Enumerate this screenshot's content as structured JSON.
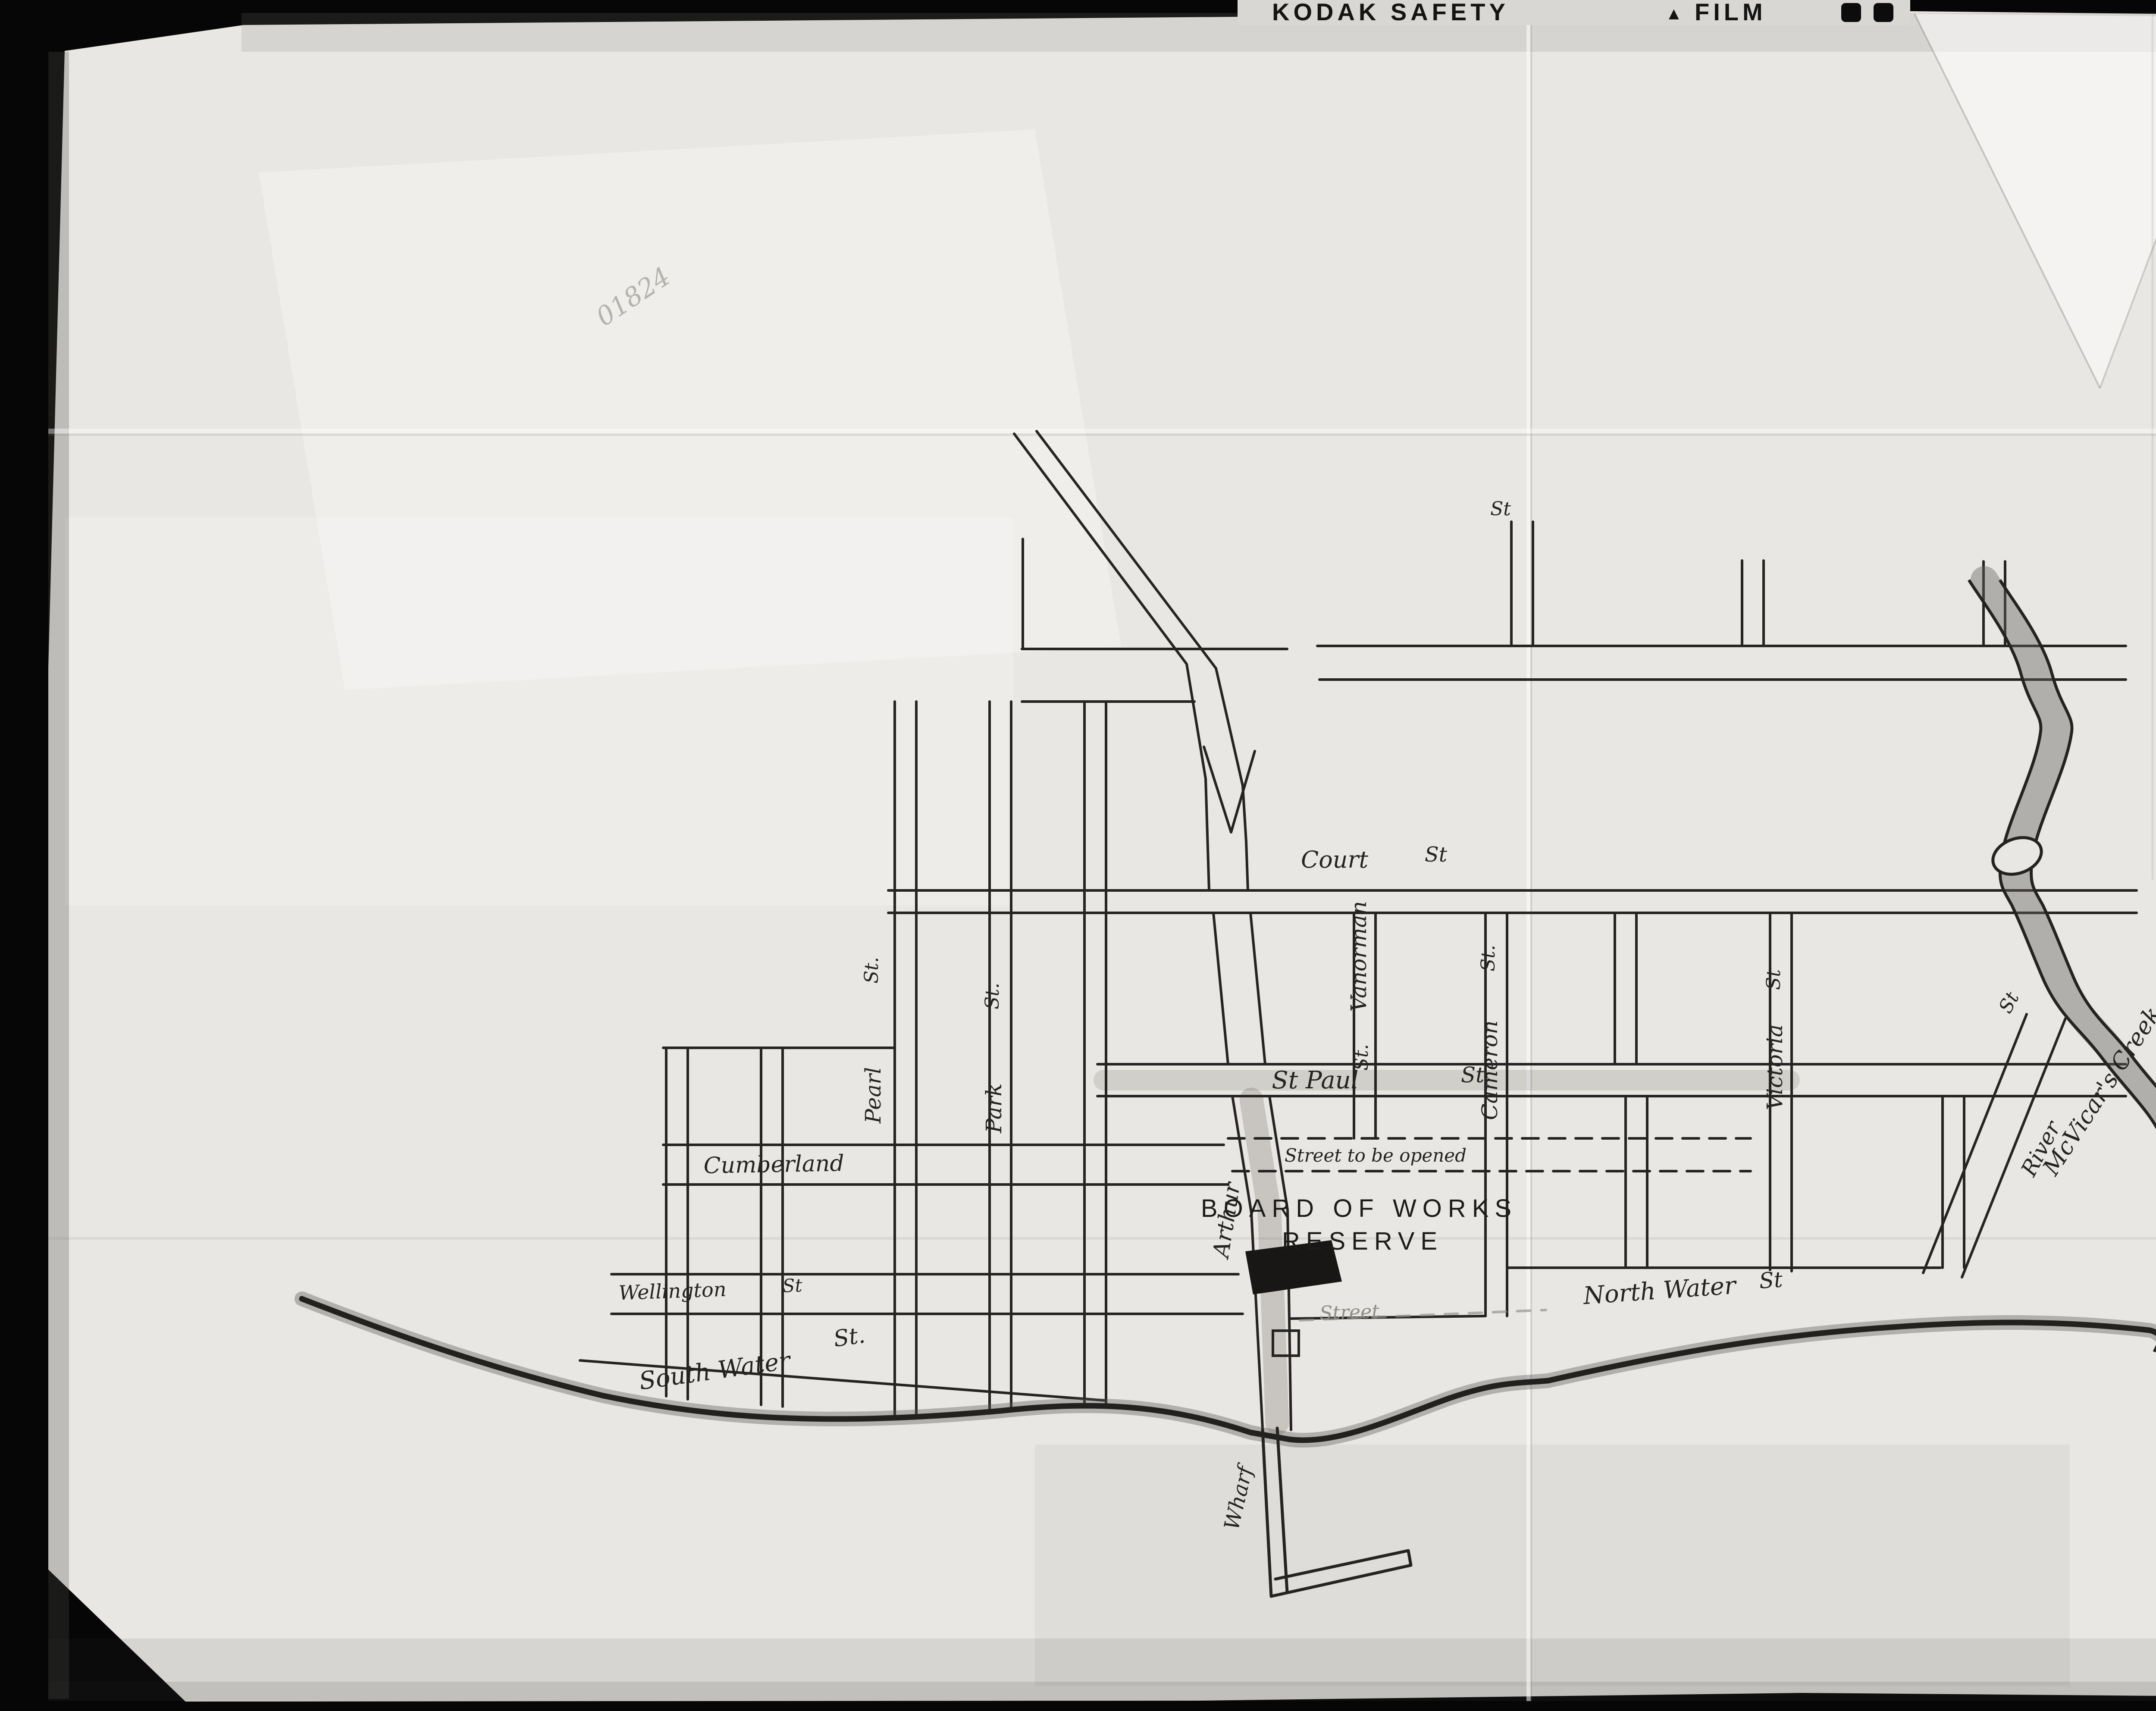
{
  "film": {
    "brand": "KODAK SAFETY",
    "brand2": "FILM",
    "triangle": "▲",
    "frame_number_stamp": "001824",
    "pencil_number": "01824",
    "corner_mark": "2a"
  },
  "title": {
    "line1": "Sketch shewing",
    "line2": "Board of Works Reserve",
    "line2_small": "at",
    "line3": "Prince Arthurs Landing",
    "line4": "Thunder Bay",
    "scale": "Scale 4 Chains to 1 Inch"
  },
  "compass": {
    "north_label": "N"
  },
  "reserve_label": {
    "line1": "BOARD OF WORKS",
    "line2": "RESERVE"
  },
  "streets": {
    "court": "Court",
    "court_suffix": "St",
    "st_paul": "St Paul",
    "st_paul_suffix": "St",
    "top_street_suffix": "St",
    "cumberland": "Cumberland",
    "street_to_be_opened": "Street to be opened",
    "street_faint": "Street",
    "wellington": "Wellington",
    "wellington_suffix": "St",
    "south_water": "South Water",
    "south_water_suffix": "St.",
    "north_water": "North Water",
    "north_water_suffix": "St",
    "pearl": "Pearl",
    "pearl_suffix": "St.",
    "park": "Park",
    "park_suffix": "St.",
    "vanorman": "Vanorman",
    "vanorman_suffix": "St.",
    "cameron": "Cameron",
    "cameron_suffix": "St.",
    "victoria": "Victoria",
    "victoria_suffix": "St",
    "arthur": "Arthur",
    "river": "River",
    "river_suffix": "St",
    "wharf": "Wharf"
  },
  "water": {
    "creek_label": "McVicar's Creek"
  },
  "colors": {
    "ink": "#262422",
    "paper": "#e9e7e3",
    "film_black": "#060606",
    "faint_ink": "#8f8d88",
    "stamp_gray": "#a3a19c",
    "pencil_gray": "#b5b3ae"
  }
}
